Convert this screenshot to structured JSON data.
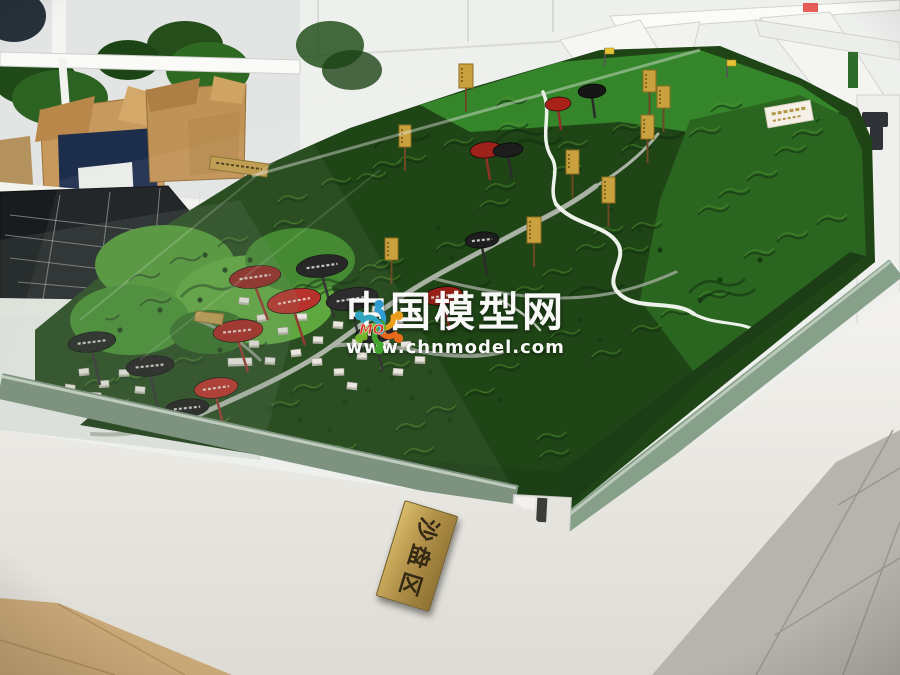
{
  "watermark": {
    "title": "中国模型网",
    "url": "www.chnmodel.com",
    "logo_text": "MO",
    "title_color": "#ffffff",
    "logo_red": "#e0301e",
    "logo_colors": [
      "#2f9fd6",
      "#f0a11c",
      "#ee6a1a",
      "#43a72e",
      "#76b82a",
      "#2fa8c4"
    ]
  },
  "plaques": {
    "front": {
      "char1": "沙",
      "char2": "盘",
      "char3": "区"
    }
  },
  "colors": {
    "terrain_dark": "#1f4416",
    "terrain_mid": "#2e6420",
    "terrain_light": "#4f9330",
    "felt_bright": "#35862b",
    "road": "#a9b2a4",
    "river": "#edf3ea",
    "sign_red": "#b3271f",
    "sign_dark_red": "#8c1f1a",
    "sign_black": "#1c1c1c",
    "billboard_gold": "#c9a23f",
    "flag_yellow": "#e6c235",
    "plaque_gold": "#c4a452",
    "glass_edge": "#87a089",
    "table_white": "#e9e7e1",
    "floor_gray": "#b7b3ad",
    "floor_beige": "#c9a878",
    "room_white": "#eef0ee"
  }
}
